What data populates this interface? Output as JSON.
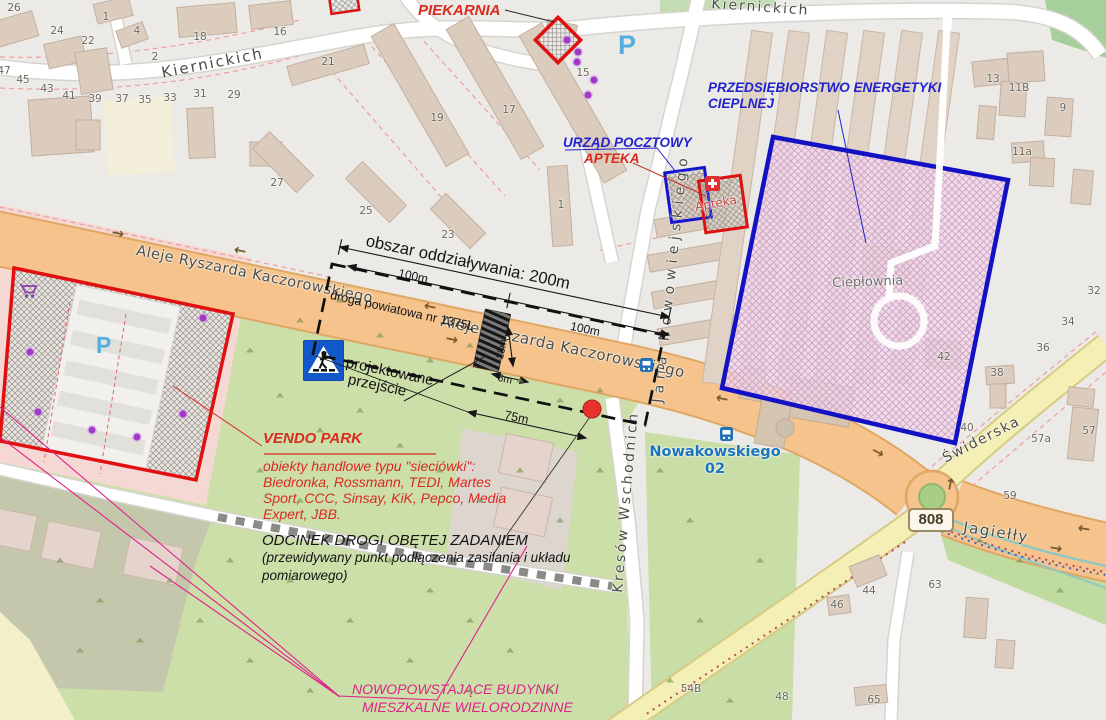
{
  "annotations": {
    "piekarnia": "PIEKARNIA",
    "urzad_pocztowy": "URZĄD POCZTOWY",
    "apteka": "APTEKA",
    "energetyka_line1": "PRZEDSIĘBIORSTWO ENERGETYKI",
    "energetyka_line2": "CIEPLNEJ",
    "obszar": "obszar oddziaływania: 200m",
    "dim_100m_a": "100m",
    "dim_100m_b": "100m",
    "dim_18m": "18m",
    "dim_6m": "6m",
    "dim_75m": "75m",
    "droga_powiatowa": "droga powiatowa nr 1375L",
    "projektowane_line1": "projektowane",
    "projektowane_line2": "przejście",
    "vendo_title": "VENDO PARK",
    "vendo_line1": "obiekty handlowe typu \"sieciówki\":",
    "vendo_line2": "Biedronka, Rossmann, TEDI, Martes",
    "vendo_line3": "Sport, CCC, Sinsay, KiK, Pepco, Media",
    "vendo_line4": "Expert, JBB.",
    "odcinek_line1": "ODCINEK DROGI OBĘTEJ ZADANIEM",
    "odcinek_line2": "(przewidywany punkt podłączenia zasilania i układu",
    "odcinek_line3": "pomiarowego)",
    "nowe_line1": "NOWOPOWSTAJĄCE BUDYNKI",
    "nowe_line2": "MIESZKALNE WIELORODZINNE"
  },
  "map": {
    "streets": {
      "kiernickich_w": "Kiernickich",
      "kiernickich_e": "Kiernickich",
      "jana": "Jana Nowowiejskiego",
      "kresow": "Kresów Wschodnich",
      "aleje": "Aleje Ryszarda Kaczorowskiego",
      "swiderska": "Świderska",
      "jagielly": "Jagiełły"
    },
    "pois": {
      "cieplownia": "Ciepłownia",
      "apteka_map": "Apteka",
      "bus_stop_name": "Nowakowskiego",
      "bus_stop_no": "02",
      "parking": "P",
      "road_ref": "808"
    },
    "house_numbers": [
      {
        "t": "26",
        "x": 14,
        "y": 8
      },
      {
        "t": "24",
        "x": 57,
        "y": 31
      },
      {
        "t": "22",
        "x": 88,
        "y": 41
      },
      {
        "t": "1",
        "x": 106,
        "y": 17
      },
      {
        "t": "4",
        "x": 137,
        "y": 31
      },
      {
        "t": "2",
        "x": 155,
        "y": 57
      },
      {
        "t": "18",
        "x": 200,
        "y": 37
      },
      {
        "t": "16",
        "x": 280,
        "y": 32
      },
      {
        "t": "21",
        "x": 328,
        "y": 62
      },
      {
        "t": "47",
        "x": 4,
        "y": 71
      },
      {
        "t": "45",
        "x": 23,
        "y": 80
      },
      {
        "t": "43",
        "x": 47,
        "y": 89
      },
      {
        "t": "41",
        "x": 69,
        "y": 96
      },
      {
        "t": "39",
        "x": 95,
        "y": 99
      },
      {
        "t": "37",
        "x": 122,
        "y": 99
      },
      {
        "t": "35",
        "x": 145,
        "y": 100
      },
      {
        "t": "33",
        "x": 170,
        "y": 98
      },
      {
        "t": "31",
        "x": 200,
        "y": 94
      },
      {
        "t": "29",
        "x": 234,
        "y": 95
      },
      {
        "t": "27",
        "x": 277,
        "y": 183
      },
      {
        "t": "25",
        "x": 366,
        "y": 211
      },
      {
        "t": "23",
        "x": 448,
        "y": 235
      },
      {
        "t": "19",
        "x": 437,
        "y": 118
      },
      {
        "t": "17",
        "x": 509,
        "y": 110
      },
      {
        "t": "15",
        "x": 583,
        "y": 73
      },
      {
        "t": "13",
        "x": 993,
        "y": 79
      },
      {
        "t": "11B",
        "x": 1019,
        "y": 88
      },
      {
        "t": "9",
        "x": 1063,
        "y": 108
      },
      {
        "t": "11a",
        "x": 1022,
        "y": 152
      },
      {
        "t": "1",
        "x": 561,
        "y": 205
      },
      {
        "t": "42",
        "x": 944,
        "y": 357
      },
      {
        "t": "32",
        "x": 1094,
        "y": 291
      },
      {
        "t": "34",
        "x": 1068,
        "y": 322
      },
      {
        "t": "36",
        "x": 1043,
        "y": 348
      },
      {
        "t": "38",
        "x": 997,
        "y": 373
      },
      {
        "t": "40",
        "x": 967,
        "y": 428
      },
      {
        "t": "57a",
        "x": 1041,
        "y": 439
      },
      {
        "t": "57",
        "x": 1089,
        "y": 431
      },
      {
        "t": "59",
        "x": 1010,
        "y": 496
      },
      {
        "t": "63",
        "x": 935,
        "y": 585
      },
      {
        "t": "44",
        "x": 869,
        "y": 591
      },
      {
        "t": "46",
        "x": 837,
        "y": 605
      },
      {
        "t": "65",
        "x": 874,
        "y": 700
      },
      {
        "t": "48",
        "x": 782,
        "y": 697
      },
      {
        "t": "54B",
        "x": 691,
        "y": 689
      }
    ],
    "poi_dots": [
      {
        "x": 567,
        "y": 40
      },
      {
        "x": 578,
        "y": 52
      },
      {
        "x": 577,
        "y": 62
      },
      {
        "x": 594,
        "y": 80
      },
      {
        "x": 588,
        "y": 95
      },
      {
        "x": 203,
        "y": 318
      },
      {
        "x": 30,
        "y": 352
      },
      {
        "x": 38,
        "y": 412
      },
      {
        "x": 92,
        "y": 430
      },
      {
        "x": 137,
        "y": 437
      },
      {
        "x": 183,
        "y": 414
      }
    ],
    "arrow_glyph": "→",
    "road_arrows": [
      {
        "x": 118,
        "y": 233,
        "r": 12
      },
      {
        "x": 240,
        "y": 251,
        "r": 192
      },
      {
        "x": 430,
        "y": 307,
        "r": 192
      },
      {
        "x": 452,
        "y": 339,
        "r": 12
      },
      {
        "x": 722,
        "y": 399,
        "r": 192
      },
      {
        "x": 878,
        "y": 452,
        "r": 28
      },
      {
        "x": 1084,
        "y": 529,
        "r": 190
      },
      {
        "x": 1056,
        "y": 548,
        "r": 10
      },
      {
        "x": 950,
        "y": 484,
        "r": -78
      }
    ]
  },
  "colors": {
    "road_orange": "#F5C38B",
    "road_yellow": "#F4EFB4",
    "green": "#CBDFA7",
    "overlay_blue": "#1212C4",
    "overlay_red": "#DD1111",
    "annotation_red": "#D92B1F",
    "annotation_navy": "#2222CC",
    "annotation_magenta": "#E0218A",
    "transit_blue": "#1B74BC"
  }
}
